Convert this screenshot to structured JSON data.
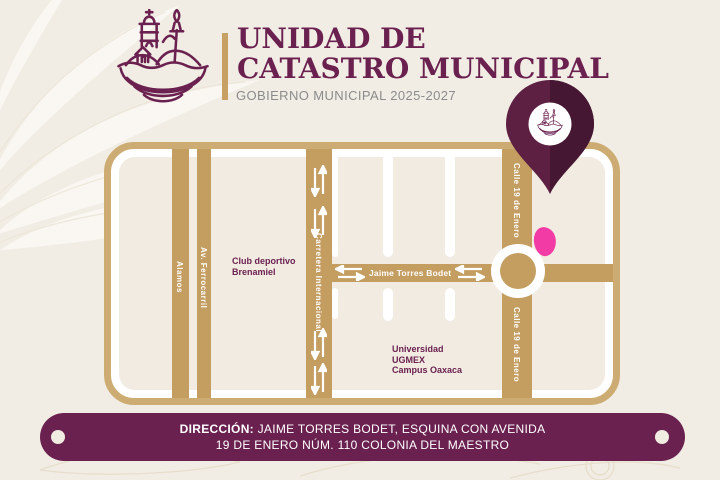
{
  "header": {
    "title_line1": "UNIDAD DE",
    "title_line2": "CATASTRO MUNICIPAL",
    "subtitle": "GOBIERNO MUNICIPAL 2025-2027"
  },
  "map": {
    "street_labels": {
      "alamos": "Alamos",
      "av_ferrocarril": "Av. Ferrocarril",
      "carretera_internacional": "Carretera Internacional",
      "jaime_torres_bodet": "Jaime Torres Bodet",
      "calle_19_top": "Calle 19 de Enero",
      "calle_19_bottom": "Calle 19 de Enero"
    },
    "places": {
      "club_line1": "Club deportivo",
      "club_line2": "Brenamiel",
      "uni_line1": "Universidad",
      "uni_line2": "UGMEX",
      "uni_line3": "Campus Oaxaca"
    }
  },
  "footer": {
    "label": "DIRECCIÓN:",
    "line1_rest": " JAIME TORRES BODET, ESQUINA CON AVENIDA",
    "line2": "19 DE ENERO NÚM. 110 COLONIA DEL MAESTRO"
  },
  "colors": {
    "maroon": "#6b2150",
    "maroon_dark": "#451733",
    "gold_border": "#cdac74",
    "street_tan": "#c49d61",
    "page_cream": "#f2ede4",
    "map_beige": "#f1ebe1",
    "pink_marker": "#f33ba5",
    "subtitle_gray": "#8b8b8b"
  }
}
